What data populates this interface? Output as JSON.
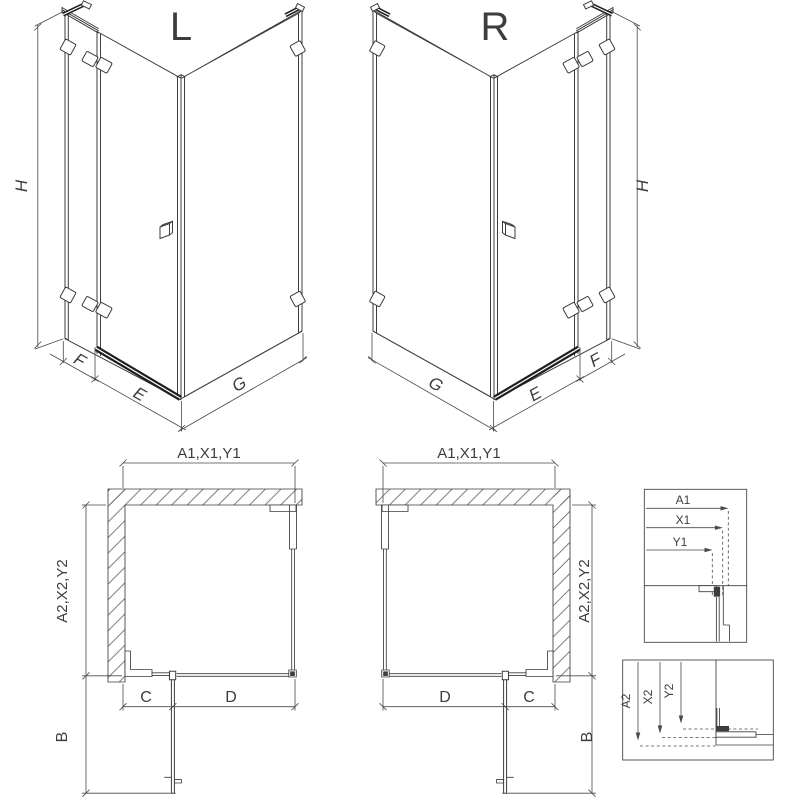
{
  "colors": {
    "background": "#ffffff",
    "line": "#3d3d3d",
    "dim": "#4a4a4a",
    "hatch": "#6e6e6e",
    "threshold": "#1e1e1e"
  },
  "units": {
    "left": {
      "variant_label": "L",
      "dims": {
        "height": "H",
        "panel": "F",
        "door": "E",
        "side": "G"
      }
    },
    "right": {
      "variant_label": "R",
      "dims": {
        "height": "H",
        "panel": "F",
        "door": "E",
        "side": "G"
      }
    }
  },
  "plans": {
    "left": {
      "width_dim": "A1,X1,Y1",
      "depth_dim": "A2,X2,Y2",
      "door_projection": "B",
      "segment_c": "C",
      "segment_d": "D"
    },
    "right": {
      "width_dim": "A1,X1,Y1",
      "depth_dim": "A2,X2,Y2",
      "door_projection": "B",
      "segment_c": "C",
      "segment_d": "D"
    }
  },
  "details": {
    "width_box": {
      "labels": [
        "A1",
        "X1",
        "Y1"
      ]
    },
    "depth_box": {
      "labels": [
        "A2",
        "X2",
        "Y2"
      ]
    }
  }
}
